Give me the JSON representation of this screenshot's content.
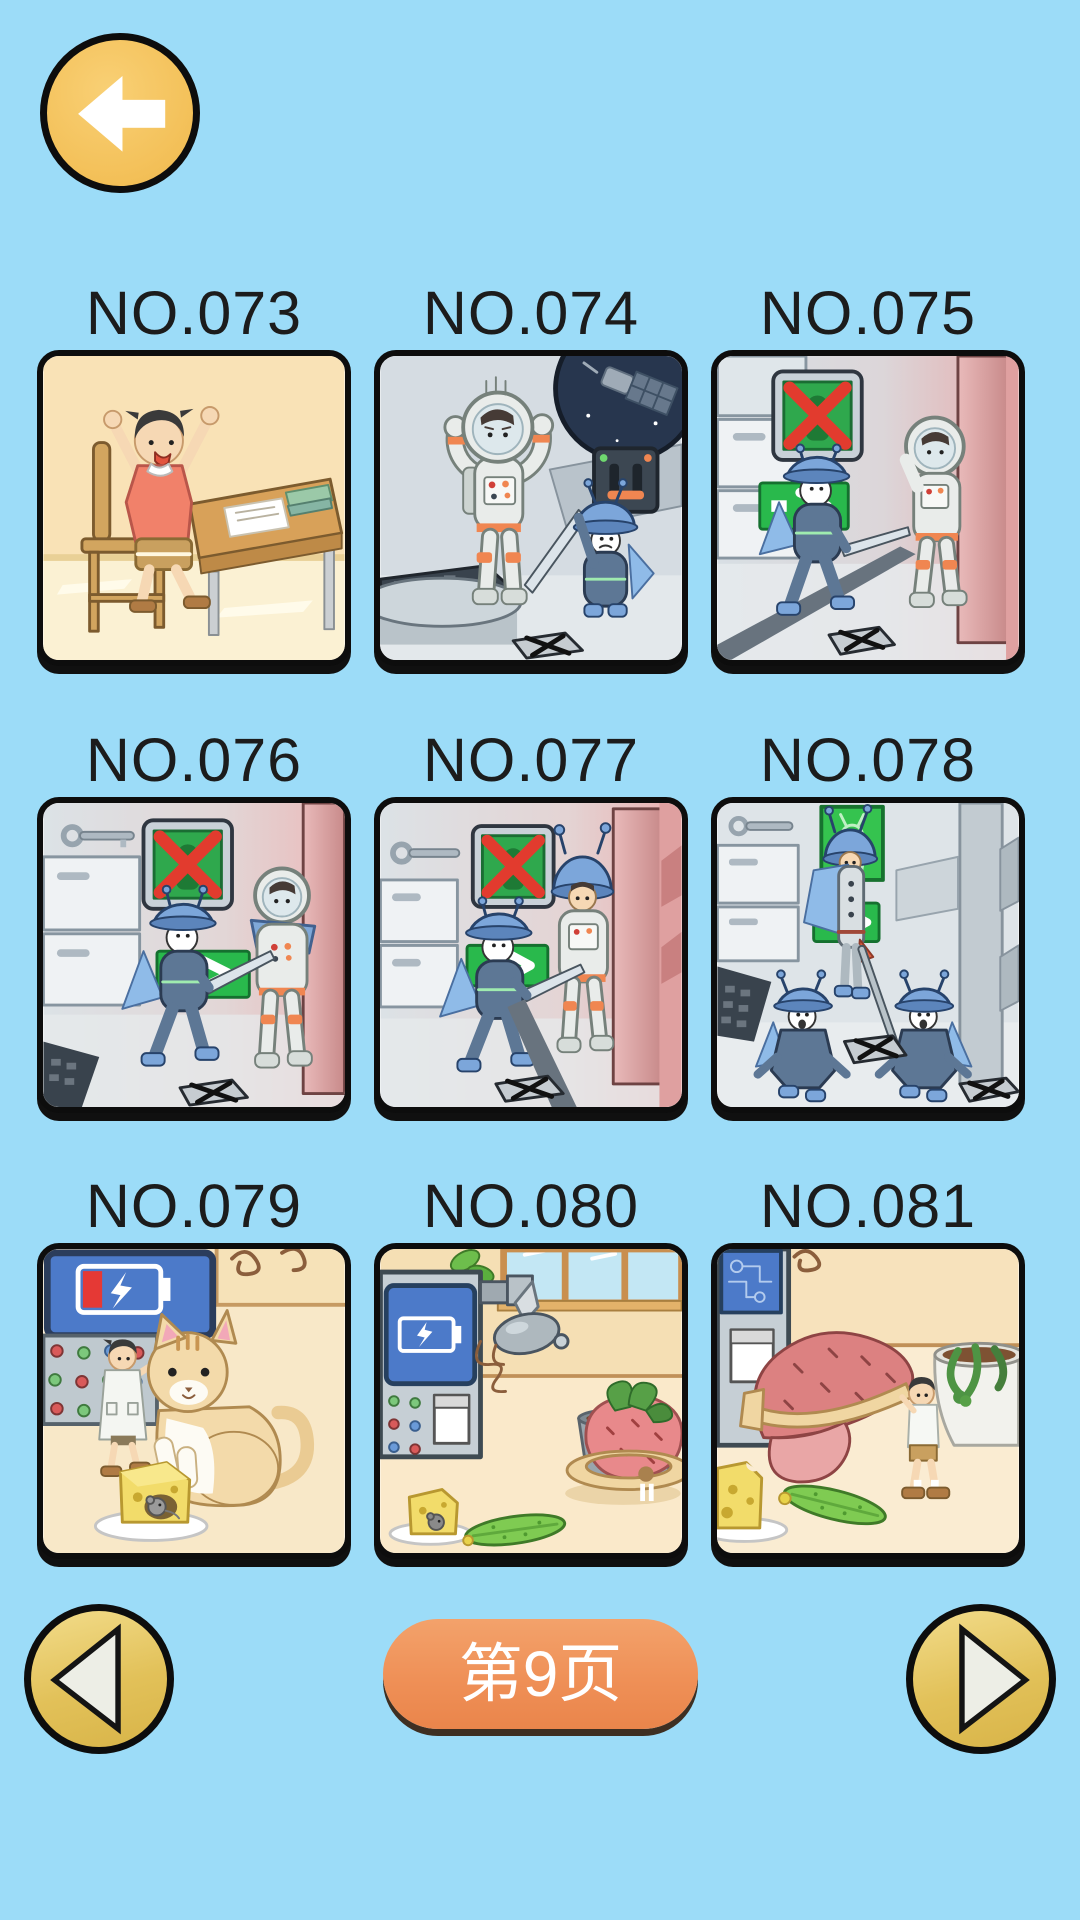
{
  "app": {
    "background_color": "#9CDCF8"
  },
  "header": {
    "back_button": {
      "icon": "back-arrow",
      "color": "#F3C058"
    }
  },
  "levels": [
    {
      "id": "NO.073",
      "scene": "boy celebrating at classroom desk"
    },
    {
      "id": "NO.074",
      "scene": "astronaut hands up, alien with sword, space window"
    },
    {
      "id": "NO.075",
      "scene": "no-alien sign, alien chasing astronaut by red pillar"
    },
    {
      "id": "NO.076",
      "scene": "no-alien sign, alien with sword pointing at exit arrow"
    },
    {
      "id": "NO.077",
      "scene": "alien with sword faces astronaut wearing alien helmet"
    },
    {
      "id": "NO.078",
      "scene": "disguised astronaut saluted by two kneeling aliens"
    },
    {
      "id": "NO.079",
      "scene": "low battery lab, boy scientist, giant cat, cheese with mouse"
    },
    {
      "id": "NO.080",
      "scene": "lab machine charging, giant strawberry in pot, cucumber"
    },
    {
      "id": "NO.081",
      "scene": "boy carrying giant sweet potato to planting pot"
    }
  ],
  "pagination": {
    "current_page_label": "第9页",
    "prev_icon": "left-triangle",
    "next_icon": "right-triangle",
    "pill_color": "#EF9057",
    "button_color": "#E2C159"
  }
}
